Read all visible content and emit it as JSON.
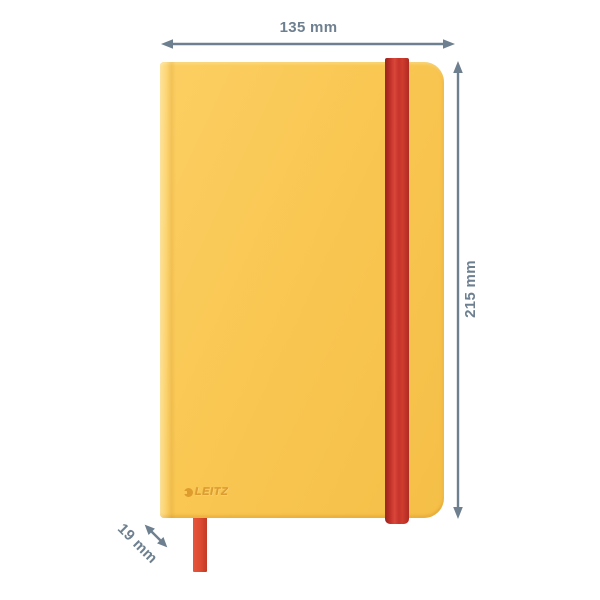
{
  "theme": {
    "background": "#ffffff",
    "cover": "#f9c752",
    "cover_light": "#fccf63",
    "cover_dark": "#f5bf47",
    "band": "#c5332b",
    "band_dark": "#9c2621",
    "band_light": "#d8473a",
    "ribbon": "#dc4a31",
    "ribbon_light": "#e6553c",
    "ribbon_dark": "#c23a24",
    "annotation": "#6e8090",
    "logo": "#de9c2e"
  },
  "product": {
    "name": "yellow hardcover notebook",
    "brand": "LEITZ"
  },
  "dimensions": {
    "width": "135 mm",
    "height": "215 mm",
    "thickness": "19 mm"
  }
}
